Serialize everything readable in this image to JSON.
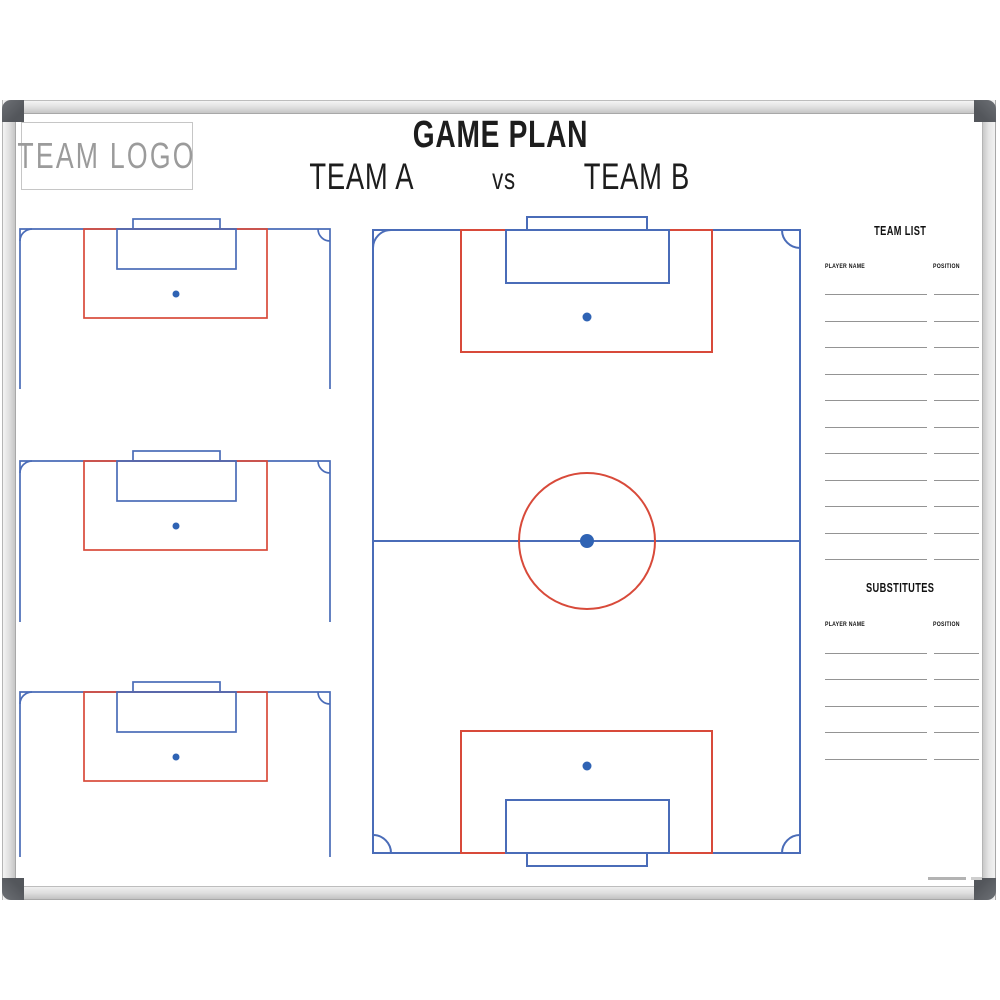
{
  "header": {
    "logo_text": "TEAM LOGO",
    "title": "GAME PLAN",
    "team_a": "TEAM A",
    "vs": "vs",
    "team_b": "TEAM B"
  },
  "team_list": {
    "title": "TEAM LIST",
    "player_col": "PLAYER NAME",
    "position_col": "POSITION",
    "row_count": 11
  },
  "substitutes": {
    "title": "SUBSTITUTES",
    "player_col": "PLAYER NAME",
    "position_col": "POSITION",
    "row_count": 5
  },
  "pitches": {
    "mini_half_pitch_count": 3,
    "full_pitch_count": 1
  },
  "colors": {
    "line_blue": "#4a6cb8",
    "line_red": "#d84a3a",
    "dot_blue": "#2f63b4",
    "write_line": "#949494",
    "logo_text": "#9b9b9b",
    "title_text": "#1d1d1d"
  }
}
